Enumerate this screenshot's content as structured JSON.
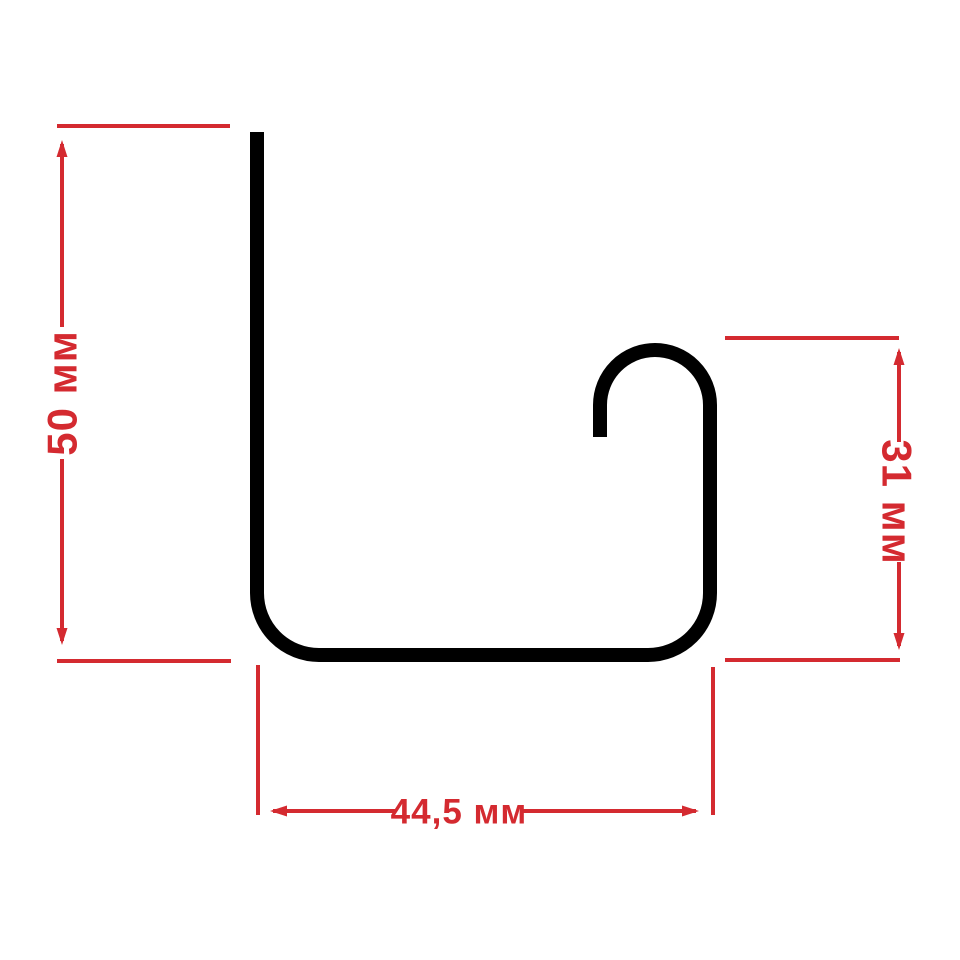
{
  "page": {
    "background_color": "#ffffff"
  },
  "drawing": {
    "profile_color": "#000000",
    "dimension_color": "#d42a30",
    "dimensions": {
      "height": {
        "label": "50 мм",
        "value": 50,
        "unit": "мм"
      },
      "hook_height": {
        "label": "31 мм",
        "value": 31,
        "unit": "мм"
      },
      "width": {
        "label": "44,5 мм",
        "value": 44.5,
        "unit": "мм"
      }
    }
  }
}
